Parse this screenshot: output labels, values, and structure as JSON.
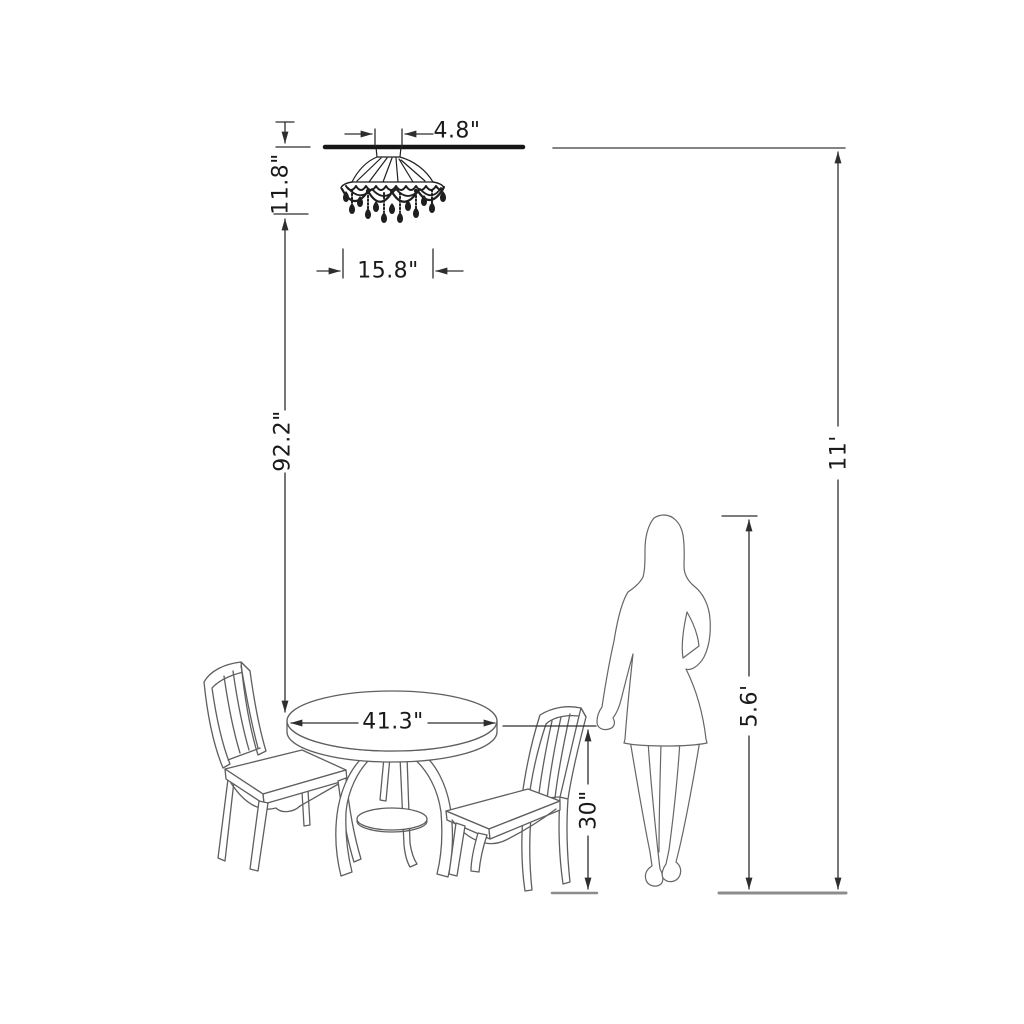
{
  "dimensions": {
    "canopy_width": "4.8\"",
    "fixture_height": "11.8\"",
    "fixture_width": "15.8\"",
    "fixture_to_table_clearance": "92.2\"",
    "table_diameter": "41.3\"",
    "table_height": "30\"",
    "person_height": "5.6'",
    "ceiling_height": "11'"
  },
  "colors": {
    "background": "#ffffff",
    "dimension_line": "#2e2e2e",
    "label_text": "#1a1a1a",
    "ceiling_line": "#161616",
    "ceiling_line_thin": "#5a5a5a",
    "floor_line": "#8c8c8c",
    "furniture_line": "#5f5f5f",
    "person_line": "#666666",
    "chandelier_ink": "#1f1f1f"
  },
  "figures": {
    "chandelier": "flush-mount-crystal-chandelier",
    "table": "round-pedestal-dining-table",
    "chair_left": "slat-back-side-chair",
    "chair_right": "slat-back-side-chair",
    "person": "standing-woman-silhouette"
  }
}
